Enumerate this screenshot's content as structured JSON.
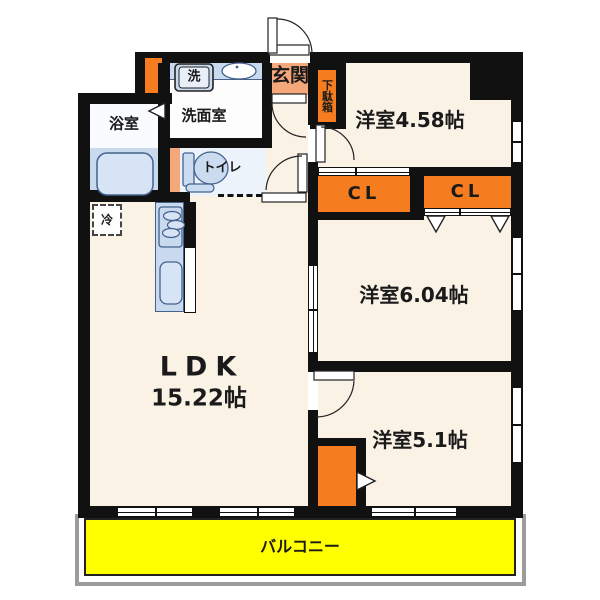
{
  "plan_type": "apartment-floorplan",
  "rooms": {
    "bath": {
      "name": "浴室"
    },
    "washroom": {
      "name": "洗面室"
    },
    "washer": {
      "name": "洗"
    },
    "entrance": {
      "name": "玄関"
    },
    "shoe_cabinet": {
      "name": "下駄箱"
    },
    "toilet": {
      "name": "トイレ"
    },
    "refrigerator": {
      "name": "冷"
    },
    "ldk": {
      "name": "LDK",
      "area": "15.22帖"
    },
    "bedroom1": {
      "name": "洋室4.58帖"
    },
    "bedroom2": {
      "name": "洋室6.04帖"
    },
    "bedroom3": {
      "name": "洋室5.1帖"
    },
    "closet1": {
      "name": "CL"
    },
    "closet2": {
      "name": "CL"
    },
    "balcony": {
      "name": "バルコニー"
    }
  },
  "palette": {
    "wall": "#111111",
    "room_cream": "#FBF2E6",
    "accent_orange": "#F57C1F",
    "accent_salmon": "#F5A77C",
    "fixture_blue": "#C9DAEF",
    "fixture_blue_outline": "#44618C",
    "service_white": "#FDFDFE",
    "toilet_blue": "#EDF3FB",
    "balcony_yellow": "#FFFF00"
  }
}
